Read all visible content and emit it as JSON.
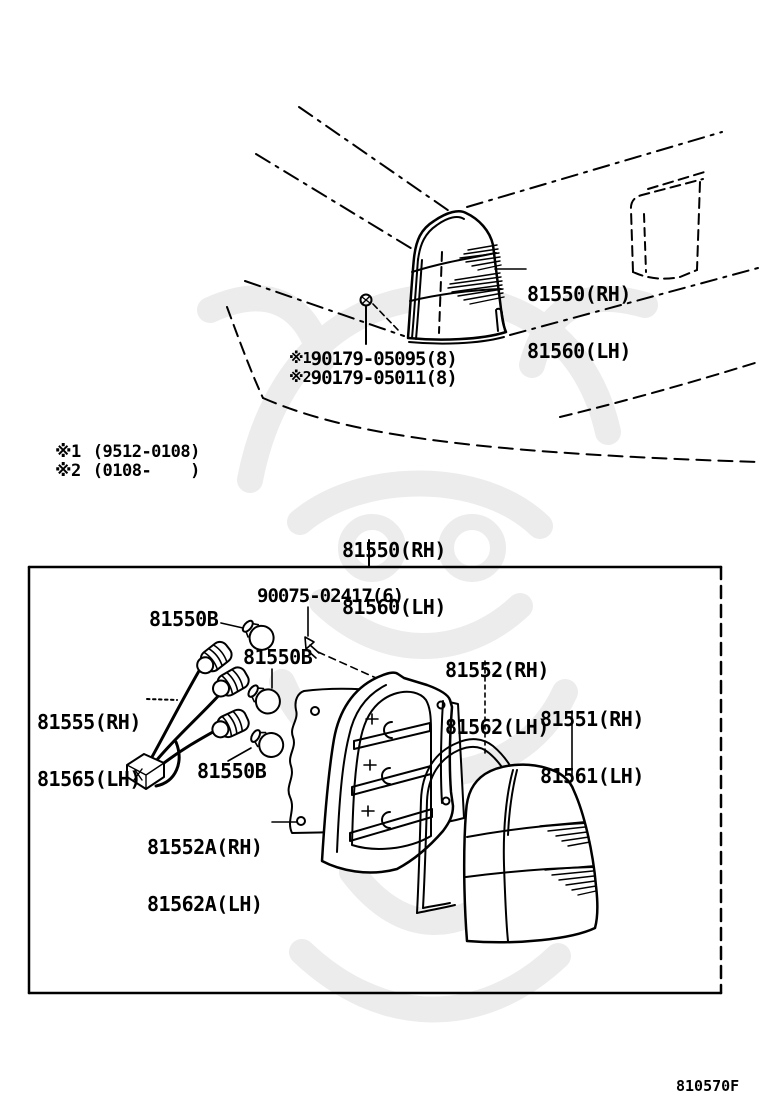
{
  "page": {
    "background": "#ffffff",
    "ink": "#000000",
    "watermark_color": "#ececec",
    "figure_code": "810570F"
  },
  "overview": {
    "lamp_assembly_label": {
      "rh": "81550(RH)",
      "lh": "81560(LH)"
    },
    "screw_parts": [
      {
        "ref": "※1",
        "number": "90179-05095(8)"
      },
      {
        "ref": "※2",
        "number": "90179-05011(8)"
      }
    ],
    "production_notes": [
      {
        "ref": "※1",
        "range": "(9512-0108)"
      },
      {
        "ref": "※2",
        "range": "(0108-    )"
      }
    ]
  },
  "exploded_box": {
    "assembly_label": {
      "rh": "81550(RH)",
      "lh": "81560(LH)"
    },
    "screw_label": "90075-02417(6)",
    "bulb_labels": [
      "81550B",
      "81550B",
      "81550B"
    ],
    "socket_wire_label": {
      "rh": "81555(RH)",
      "lh": "81565(LH)"
    },
    "packing_label": {
      "rh": "81552A(RH)",
      "lh": "81562A(LH)"
    },
    "body_label": {
      "rh": "81552(RH)",
      "lh": "81562(LH)"
    },
    "lens_label": {
      "rh": "81551(RH)",
      "lh": "81561(LH)"
    }
  }
}
